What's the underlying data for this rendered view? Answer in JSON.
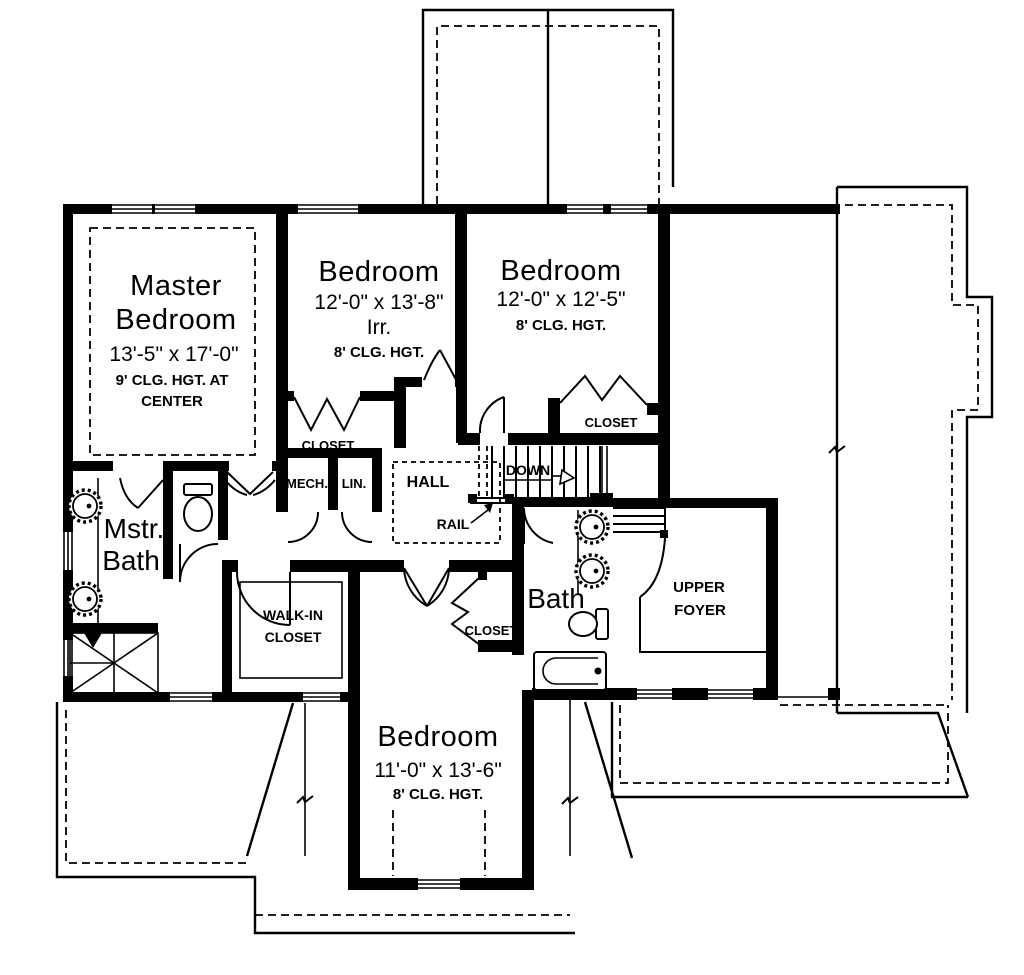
{
  "plan": {
    "floor_title": "Second Floor Plan",
    "colors": {
      "line": "#000000",
      "background": "#ffffff"
    }
  },
  "rooms": {
    "master_bedroom": {
      "line1": "Master",
      "line2": "Bedroom",
      "dims": "13'-5\" x 17'-0\"",
      "note1": "9' CLG. HGT. AT",
      "note2": "CENTER"
    },
    "bedroom2": {
      "name": "Bedroom",
      "dims": "12'-0\" x 13'-8\"",
      "irr": "Irr.",
      "note": "8' CLG. HGT."
    },
    "bedroom3": {
      "name": "Bedroom",
      "dims": "12'-0\" x 12'-5\"",
      "note": "8' CLG. HGT."
    },
    "bedroom4": {
      "name": "Bedroom",
      "dims": "11'-0\" x 13'-6\"",
      "note": "8' CLG. HGT."
    },
    "master_bath": {
      "line1": "Mstr.",
      "line2": "Bath"
    },
    "bath": {
      "name": "Bath"
    },
    "upper_foyer": {
      "line1": "UPPER",
      "line2": "FOYER"
    },
    "walk_in_closet": {
      "line1": "WALK-IN",
      "line2": "CLOSET"
    },
    "hall": {
      "name": "HALL"
    },
    "mech": {
      "name": "MECH."
    },
    "linen": {
      "name": "LIN."
    }
  },
  "closets": {
    "bedroom2": "CLOSET",
    "bedroom3": "CLOSET",
    "bedroom4": "CLOSET"
  },
  "annotations": {
    "down": "DOWN",
    "rail": "RAIL"
  }
}
